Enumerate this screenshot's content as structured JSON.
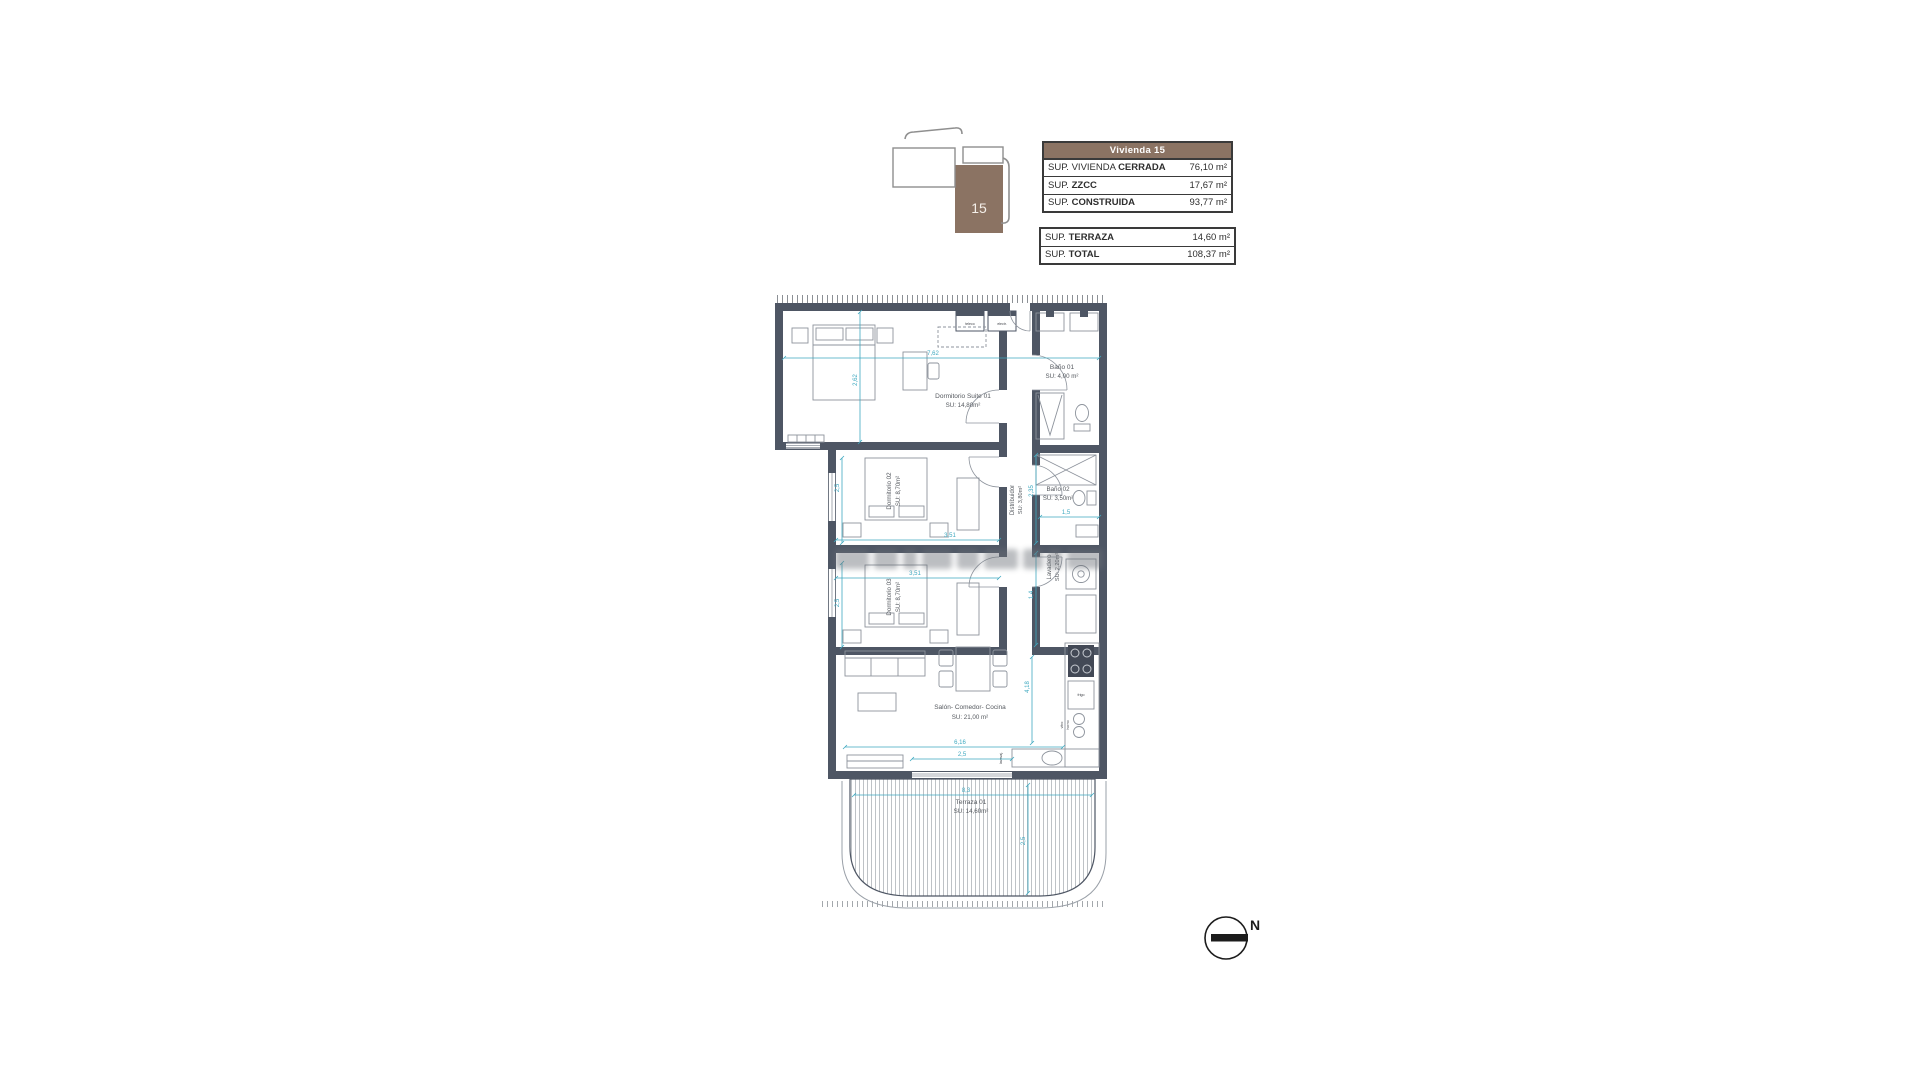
{
  "key_plan": {
    "unit": "15",
    "brown": "#8b7363"
  },
  "tables": {
    "main": {
      "header": "Vivienda 15",
      "rows": [
        {
          "prefix": "SUP. VIVIENDA ",
          "name": "CERRADA",
          "value": "76,10 m²"
        },
        {
          "prefix": "SUP. ",
          "name": "ZZCC",
          "value": "17,67 m²"
        },
        {
          "prefix": "SUP. ",
          "name": "CONSTRUIDA",
          "value": "93,77 m²"
        }
      ]
    },
    "secondary": {
      "rows": [
        {
          "prefix": "SUP. ",
          "name": "TERRAZA",
          "value": "14,60 m²"
        },
        {
          "prefix": "SUP. ",
          "name": "TOTAL",
          "value": "108,37 m²"
        }
      ]
    }
  },
  "plan": {
    "rooms": {
      "suite": {
        "name": "Dormitorio Suite 01",
        "area": "SU: 14,80m²"
      },
      "bano1": {
        "name": "Baño 01",
        "area": "SU: 4,00 m²"
      },
      "dorm2": {
        "name": "Dormitorio 02",
        "area": "SU: 8,70m²"
      },
      "distribuidor": {
        "name": "Distribuidor",
        "area": "SU: 3,80m²"
      },
      "bano2": {
        "name": "Baño 02",
        "area": "SU: 3,50m²"
      },
      "dorm3": {
        "name": "Dormitorio 03",
        "area": "SU: 8,70m²"
      },
      "lavadero": {
        "name": "Lavadero",
        "area": "SU: 2,20m²"
      },
      "salon": {
        "name": "Salón- Comedor- Cocina",
        "area": "SU: 21,00 m²"
      },
      "terraza": {
        "name": "Terraza 01",
        "area": "SU: 14,60m²"
      }
    },
    "dims": {
      "suite_w": "7,62",
      "suite_h": "2,62",
      "dorm2_w": "3,51",
      "dorm2_h": "2,5",
      "dorm3_w": "3,51",
      "dorm3_h": "2,5",
      "bano2_h": "2,35",
      "bano2_w": "1,5",
      "lav_h": "1,4",
      "salon_w": "6,16",
      "salon_h": "4,18",
      "salon_door": "2,5",
      "terraza_w": "8,3",
      "terraza_h": "2,5"
    },
    "tags": {
      "teleco": "teleco",
      "electr": "electr.",
      "frigo": "frigo",
      "vitro": "vitro",
      "horno": "horno",
      "lavavaj": "lavavaj."
    },
    "colors": {
      "wall": "#4e5664",
      "dimension": "#3fa9c0",
      "furniture": "#8d939c"
    }
  },
  "compass": {
    "label": "N"
  }
}
